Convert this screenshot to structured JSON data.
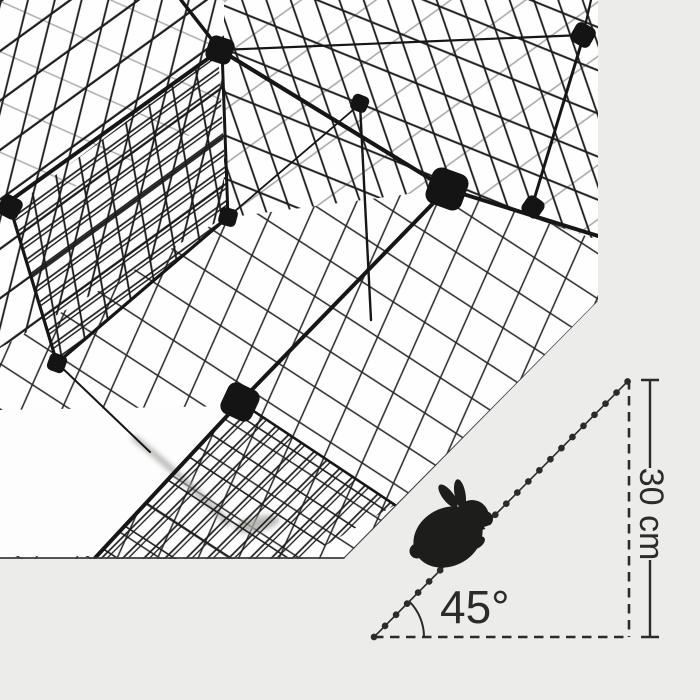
{
  "scene": {
    "description": "Metal wire pet playpen with interior mesh ramp, product dimension diagram",
    "background_color": "#ececea",
    "photo_background_color": "#fefefe",
    "wire_color": "#1c1c1c",
    "connector_color": "#141414",
    "annotation_color": "#2b2b28",
    "rabbit_color": "#1d1d1b",
    "shadow_color": "#a9a9a5"
  },
  "annotation": {
    "angle_label": "45°",
    "height_label": "30 cm",
    "incline_angle_degrees": 45,
    "ramp_height_cm": 30,
    "icons": {
      "rabbit": "rabbit-silhouette-icon"
    }
  }
}
